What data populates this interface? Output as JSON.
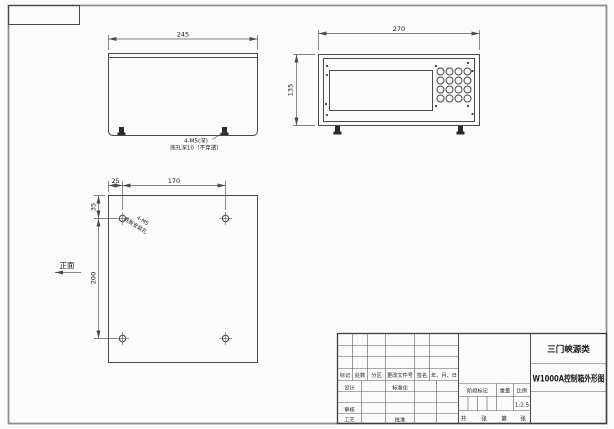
{
  "drawing": {
    "views": {
      "side_view": {
        "width_dim": "245",
        "note_line1": "4-M5(深)",
        "note_line2": "底孔深10（不穿透）"
      },
      "front_view": {
        "width_dim": "270",
        "height_dim": "135"
      },
      "base_view": {
        "edge_offset_dim": "25",
        "hole_span_dim": "170",
        "top_offset_dim": "35",
        "vertical_span_dim": "200",
        "note_line1": "4-M5",
        "note_line2": "底板安装孔",
        "front_label": "正面"
      }
    },
    "title_block": {
      "company": "三门峡源类",
      "drawing_title": "W1000A控制箱外形图",
      "header": [
        "标记",
        "处数",
        "分区",
        "更改文件号",
        "签名",
        "年、月、日"
      ],
      "design": "设计",
      "standardization": "标准化",
      "review": "审核",
      "process": "工艺",
      "approval": "批准",
      "stage_mark": "阶段标记",
      "weight": "重量",
      "scale": "比例",
      "scale_value": "1:2.5",
      "total_label": "共",
      "sheet_unit1": "张",
      "ordinal_label": "第",
      "sheet_unit2": "张"
    },
    "colors": {
      "line": "#4a4a4a",
      "text": "#1a1a1a",
      "background": "#fbfbfb"
    }
  }
}
